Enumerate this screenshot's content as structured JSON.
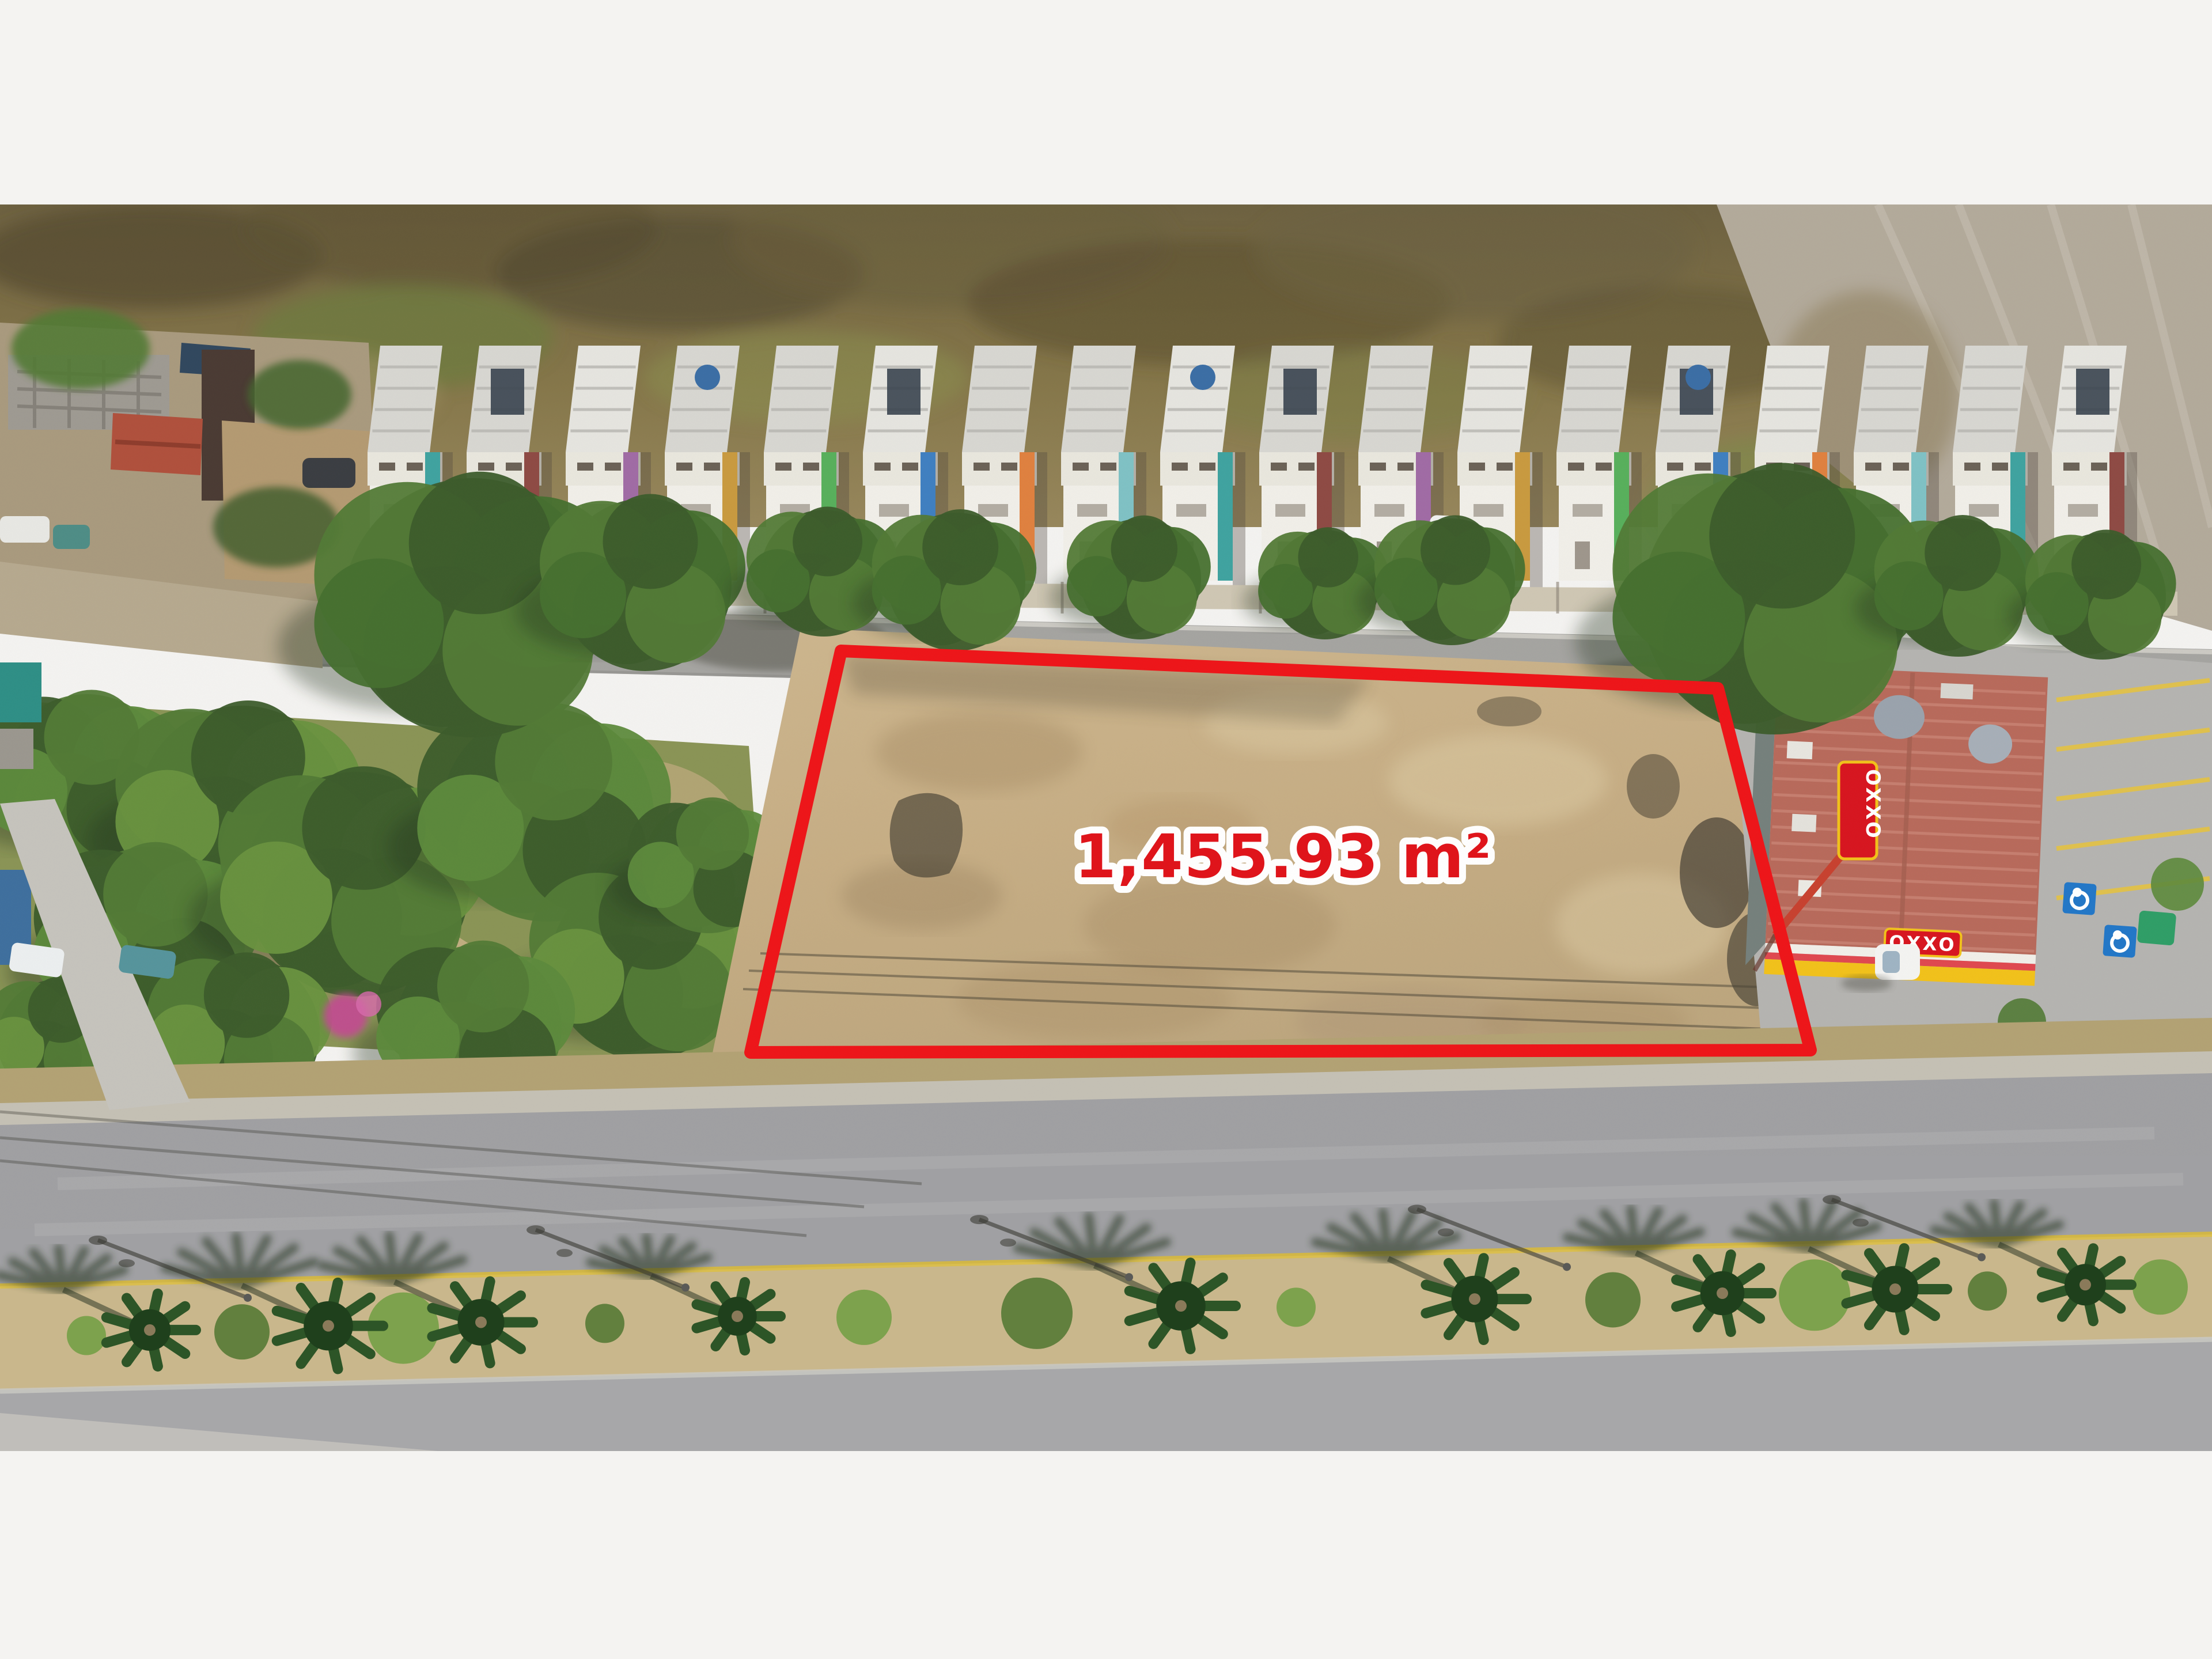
{
  "annotation": {
    "area_label": "1,455.93 m²",
    "polygon_points": "1460,775 2982,840 3143,1468 1303,1472",
    "outline_color": "#ee1418",
    "label_color": "#e01219",
    "label_outline": "#ffffff"
  },
  "store": {
    "brand": "OXXO",
    "sign_color": "#d8151f",
    "sign_text_color": "#ffffff",
    "accent_yellow": "#f2c21a"
  },
  "palette": {
    "page-bg": "#f4f3f1",
    "outline-red": "#ee1418",
    "label-red": "#e01219",
    "label-stroke": "#ffffff",
    "hill-base": "#857649",
    "hill-dark": "#4f472e",
    "hill-green": "#6e7a40",
    "hill-light": "#a89868",
    "dirt-wedge": "#b3aa9b",
    "roof-gray": "#d8d7d2",
    "roof-line": "#b7b6b1",
    "facade-white": "#f1efe9",
    "wall-white": "#e9e7de",
    "street-gray": "#a5a4a1",
    "dirt-road": "#b6a98f",
    "lot-tan": "#c7ae85",
    "lot-dark": "#a88e66",
    "lot-light": "#dbc9a2",
    "park-green": "#8a9456",
    "tree-dark": "#3c5c2b",
    "tree-mid": "#527a36",
    "tree-light": "#69923f",
    "oxxo-roof": "#b86a5b",
    "oxxo-roof-line": "#c98273",
    "oxxo-red": "#d8151f",
    "oxxo-yellow": "#f2c21a",
    "parking-gray": "#b5b4b1",
    "road-upper": "#a0a0a3",
    "road-lower": "#a7a7a9",
    "median-tan": "#c9b78c",
    "yellow-line": "#d7b93e",
    "sidewalk": "#c6c4bd",
    "palm-green": "#2d5527",
    "handicap-blue": "#2277c8",
    "shadow": "#2e2a1f"
  },
  "house_accents": [
    "#3fa3a0",
    "#8e4a44",
    "#a06ba5",
    "#c99a3f",
    "#58b05c",
    "#3f7fc1",
    "#e0813f",
    "#7fc2c5"
  ]
}
